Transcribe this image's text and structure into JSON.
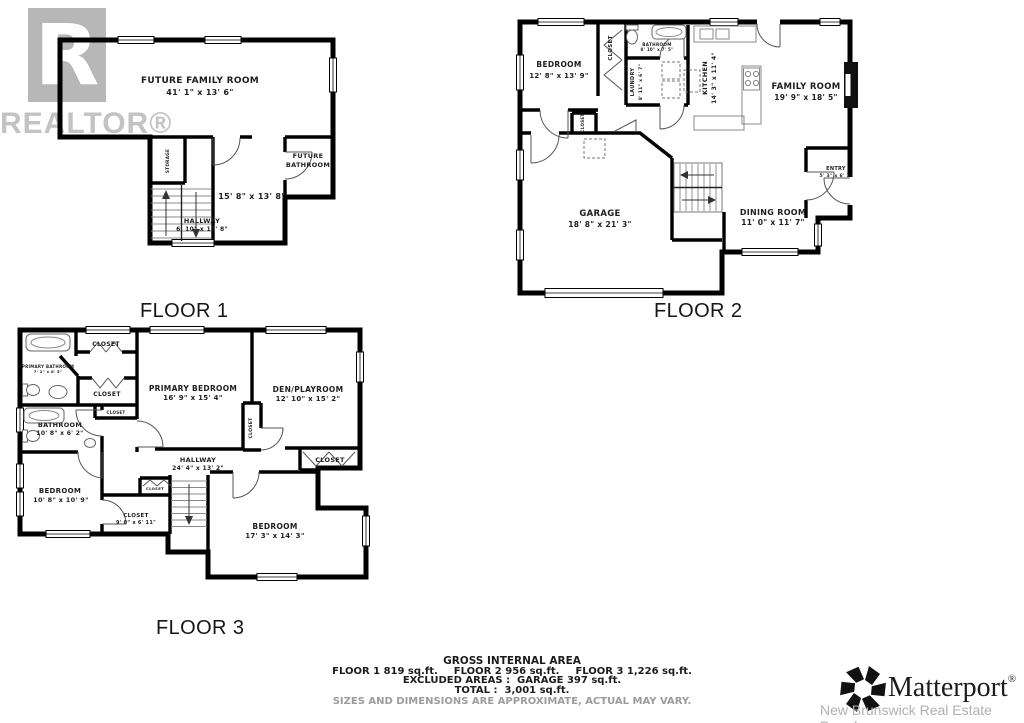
{
  "branding": {
    "realtor_r": "R",
    "realtor_text": "REALTOR®",
    "matterport_text": "Matterport",
    "matterport_reg": "®",
    "board": "New Brunswick Real Estate Board"
  },
  "floor1": {
    "label": "FLOOR 1",
    "rooms": {
      "family": {
        "name": "FUTURE FAMILY ROOM",
        "dims": "41' 1\" x 13' 6\""
      },
      "bathroom": {
        "name_l1": "FUTURE",
        "name_l2": "BATHROOM"
      },
      "lower_room": {
        "dims": "15' 8\" x 13' 8\""
      },
      "hallway": {
        "name": "HALLWAY",
        "dims": "6' 10\" x 13' 8\""
      },
      "storage": {
        "name": "STORAGE"
      }
    }
  },
  "floor2": {
    "label": "FLOOR 2",
    "rooms": {
      "bedroom": {
        "name": "BEDROOM",
        "dims": "12' 8\" x 13' 9\""
      },
      "closet_top": {
        "name": "CLOSET"
      },
      "bathroom": {
        "name": "BATHROOM",
        "dims": "8' 10\" x 7' 5\""
      },
      "laundry": {
        "name": "LAUNDRY",
        "dims": "8' 11\" x 6' 7\""
      },
      "kitchen": {
        "name": "KITCHEN",
        "dims": "14' 3\" x 11' 4\""
      },
      "family_room": {
        "name": "FAMILY ROOM",
        "dims": "19' 9\" x 18' 5\""
      },
      "garage": {
        "name": "GARAGE",
        "dims": "18' 8\" x 21' 3\""
      },
      "dining": {
        "name": "DINING ROOM",
        "dims": "11' 0\" x 11' 7\""
      },
      "entry": {
        "name": "ENTRY",
        "dims": "5' 3\" x 6' 1\""
      },
      "closet_mid": {
        "name": "CLOSET"
      }
    }
  },
  "floor3": {
    "label": "FLOOR 3",
    "rooms": {
      "closet1": {
        "name": "CLOSET"
      },
      "primary_bathroom": {
        "name": "PRIMARY BATHROOM",
        "dims": "7' 2\" x 8' 5\""
      },
      "closet2": {
        "name": "CLOSET"
      },
      "closet3": {
        "name": "CLOSET"
      },
      "bathroom": {
        "name": "BATHROOM",
        "dims": "10' 8\" x 6' 2\""
      },
      "primary_bedroom": {
        "name": "PRIMARY BEDROOM",
        "dims": "16' 9\" x 15' 4\""
      },
      "den": {
        "name": "DEN/PLAYROOM",
        "dims": "12' 10\" x 15' 2\""
      },
      "closet_vert": {
        "name": "CLOSET"
      },
      "hallway": {
        "name": "HALLWAY",
        "dims": "24' 4\" x 13' 2\""
      },
      "closet_right": {
        "name": "CLOSET"
      },
      "bedroom_left": {
        "name": "BEDROOM",
        "dims": "10' 8\" x 10' 9\""
      },
      "closet_box": {
        "name": "CLOSET"
      },
      "closet_room": {
        "name": "CLOSET",
        "dims": "9' 0\" x 6' 11\""
      },
      "bedroom_big": {
        "name": "BEDROOM",
        "dims": "17' 3\" x 14' 3\""
      }
    }
  },
  "summary": {
    "title": "GROSS INTERNAL AREA",
    "floors": [
      "FLOOR 1 819 sq.ft.",
      "FLOOR 2 956 sq.ft.",
      "FLOOR 3 1,226 sq.ft."
    ],
    "excluded": "EXCLUDED AREAS :  GAR AGE 397 sq.ft.",
    "excluded_fixed": "EXCLUDED AREAS :  GARAGE 397 sq.ft.",
    "total": "TOTAL :  3,001 sq.ft.",
    "disclaimer": "SIZES AND DIMENSIONS ARE APPROXIMATE, ACTUAL MAY VARY."
  }
}
